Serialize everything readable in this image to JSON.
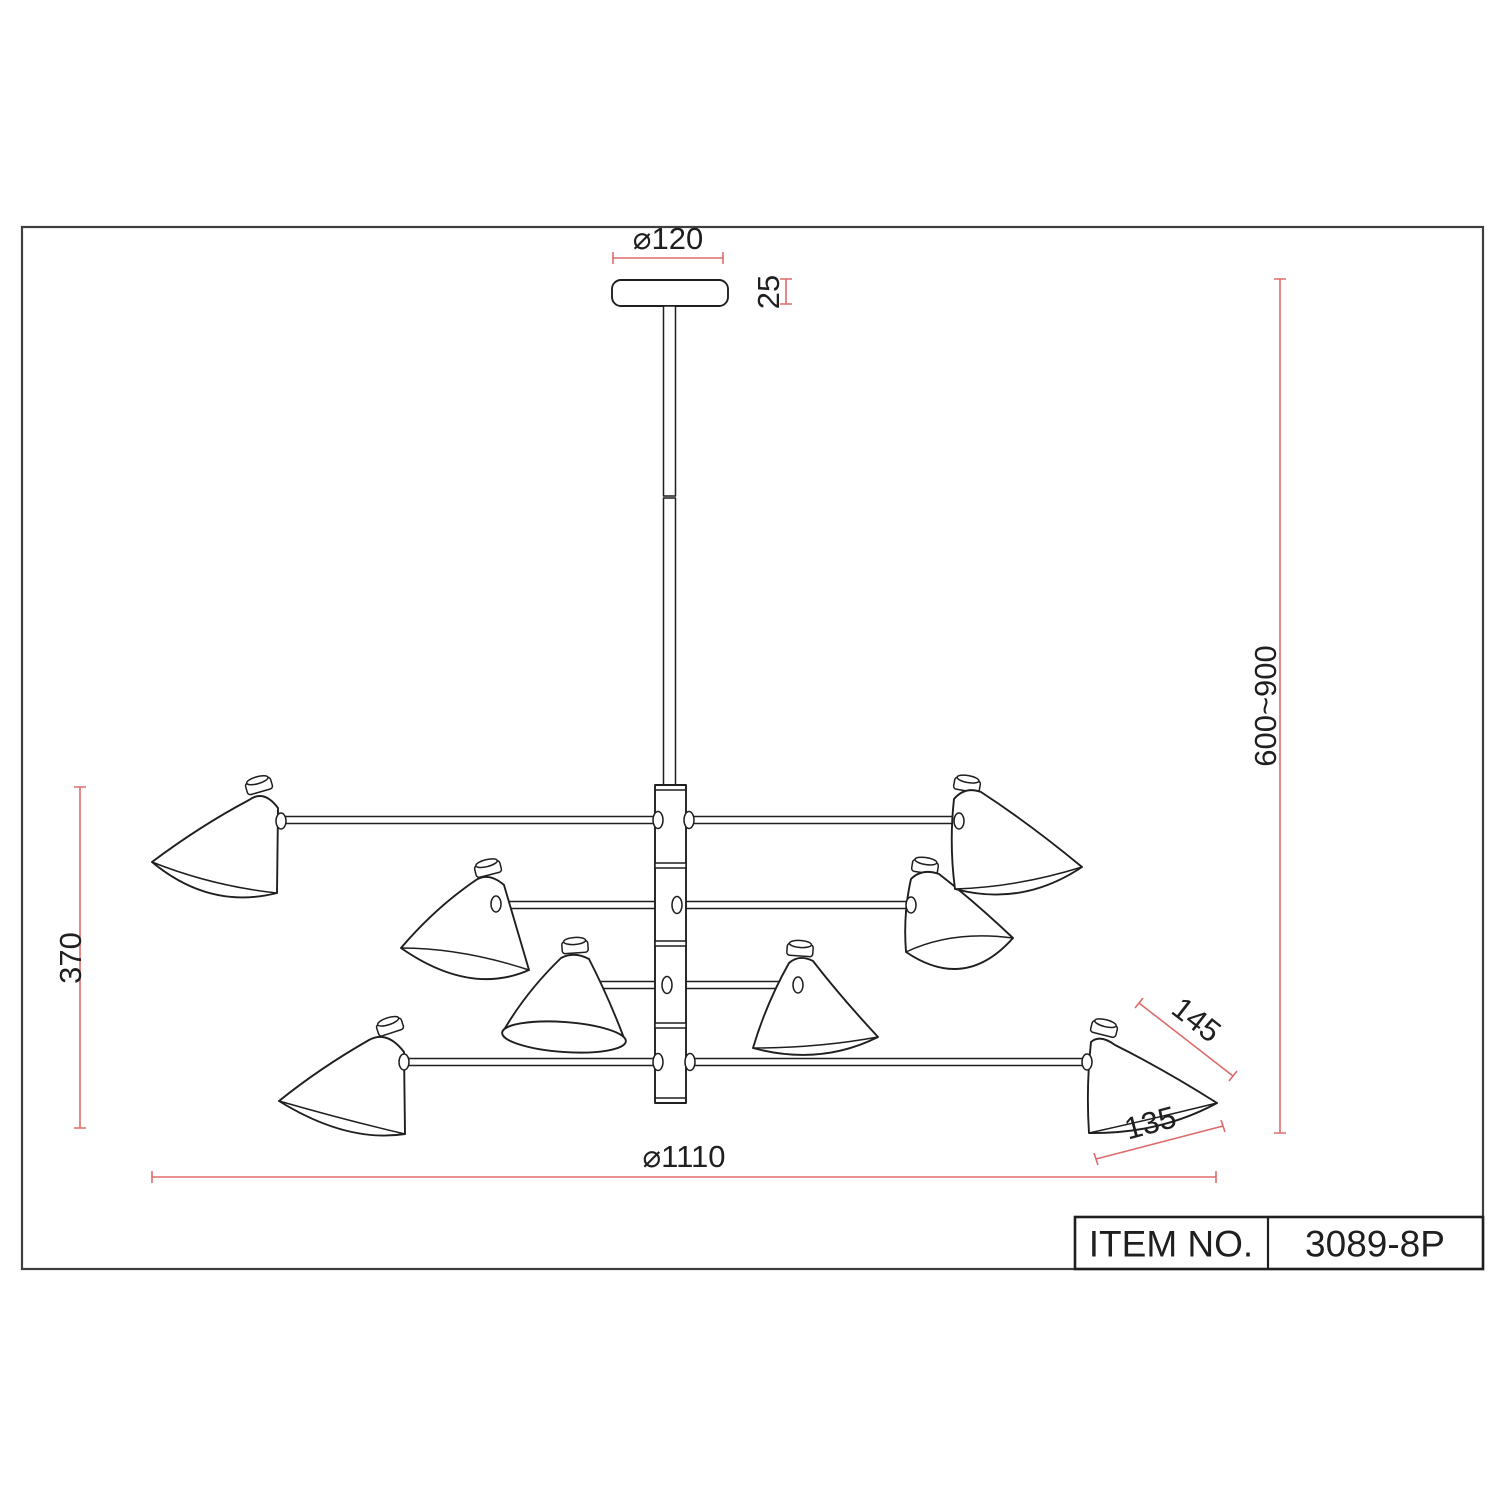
{
  "title_block": {
    "label": "ITEM NO.",
    "value": "3089-8P"
  },
  "dimensions": {
    "canopy_diameter": "⌀120",
    "canopy_thickness": "25",
    "suspension_height_range": "600~900",
    "body_height": "370",
    "overall_diameter": "⌀1110",
    "shade_slant_length": "145",
    "shade_opening_width": "135"
  },
  "colors": {
    "ink": "#1f1f1f",
    "dim": "#dd6b6b",
    "border": "#3f3f3f",
    "paper": "#ffffff"
  }
}
